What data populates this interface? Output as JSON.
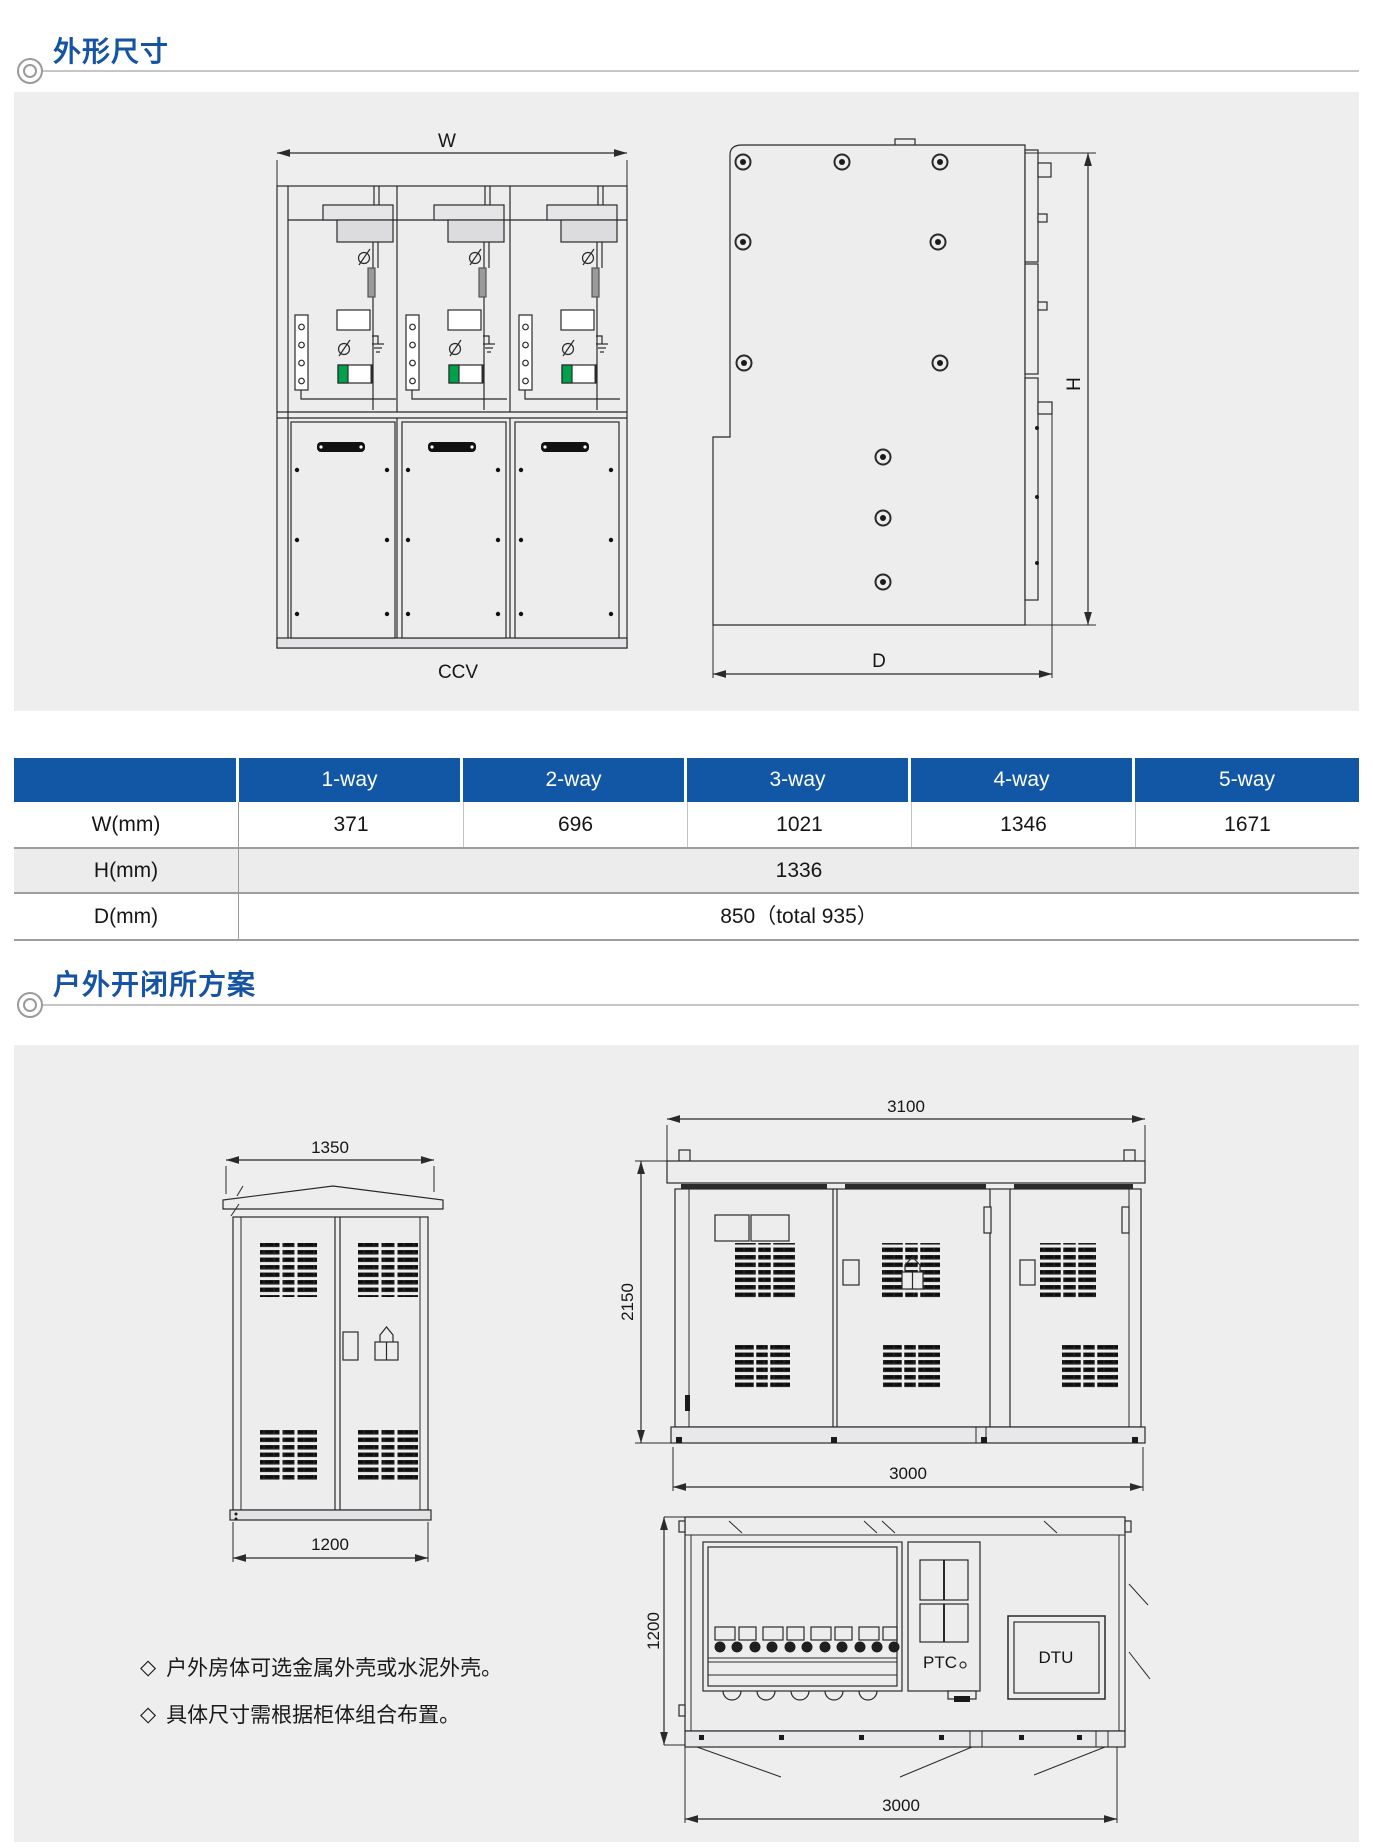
{
  "section1": {
    "title": "外形尺寸"
  },
  "section2": {
    "title": "户外开闭所方案"
  },
  "front_view": {
    "width_label": "W",
    "caption": "CCV"
  },
  "side_view": {
    "height_label": "H",
    "depth_label": "D"
  },
  "table": {
    "headers": [
      "",
      "1-way",
      "2-way",
      "3-way",
      "4-way",
      "5-way"
    ],
    "rows": [
      {
        "label": "W(mm)",
        "values": [
          "371",
          "696",
          "1021",
          "1346",
          "1671"
        ]
      },
      {
        "label": "H(mm)",
        "span_value": "1336"
      },
      {
        "label": "D(mm)",
        "span_value": "850（total 935）"
      }
    ]
  },
  "outdoor": {
    "small_cabinet": {
      "top_dim": "1350",
      "bottom_dim": "1200"
    },
    "station_front": {
      "top_dim": "3100",
      "left_dim": "2150",
      "bottom_dim": "3000"
    },
    "station_plan": {
      "left_dim": "1200",
      "bottom_dim": "3000",
      "ptc": "PTC",
      "dtu": "DTU"
    },
    "notes": [
      {
        "bullet": "◇",
        "text": "户外房体可选金属外壳或水泥外壳。"
      },
      {
        "bullet": "◇",
        "text": "具体尺寸需根据柜体组合布置。"
      }
    ]
  },
  "colors": {
    "accent": "#1553a5",
    "table_header_bg": "#1257a6",
    "panel_bg": "#eeeeef",
    "green": "#00A14B"
  }
}
